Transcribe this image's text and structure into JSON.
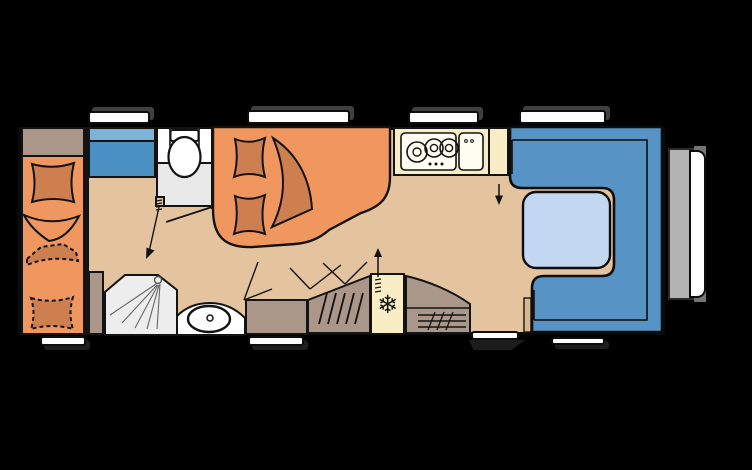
{
  "figure": "caravan-floorplan-top-view",
  "colors": {
    "bg": "#000000",
    "floor": "#e3c49e",
    "bed": "#f0975f",
    "pillow": "#cd7f50",
    "cabinet": "#ab9789",
    "kitchen": "#f8edc4",
    "seat": "#5794c5",
    "table": "#c3d8f0",
    "wardrobe": "#4a90c3",
    "wardrobe_light": "#7fb2d9",
    "bath": "#e8e8e8",
    "shower": "#ededed",
    "white": "#ffffff",
    "bumper": "#b3b3b3",
    "wood": "#d9b88d",
    "accent_dark": "#404040",
    "line": "#131313"
  },
  "icons": {
    "fridge_snowflake": "❄"
  },
  "legend": {
    "rooms": [
      "single-bed",
      "overhead-bunk-stowed",
      "top-cabinet",
      "wardrobe",
      "toilet-room",
      "shower",
      "washbasin",
      "french-double-bed",
      "kitchen-stove-3-burners",
      "kitchen-sink",
      "heater",
      "fridge",
      "hanging-wardrobe-cabinet",
      "u-shaped-dinette",
      "dinette-table"
    ],
    "openings": {
      "windows_top": 4,
      "windows_bottom": 3,
      "entry_door_bottom": 1,
      "front_panel_right": 1
    }
  }
}
